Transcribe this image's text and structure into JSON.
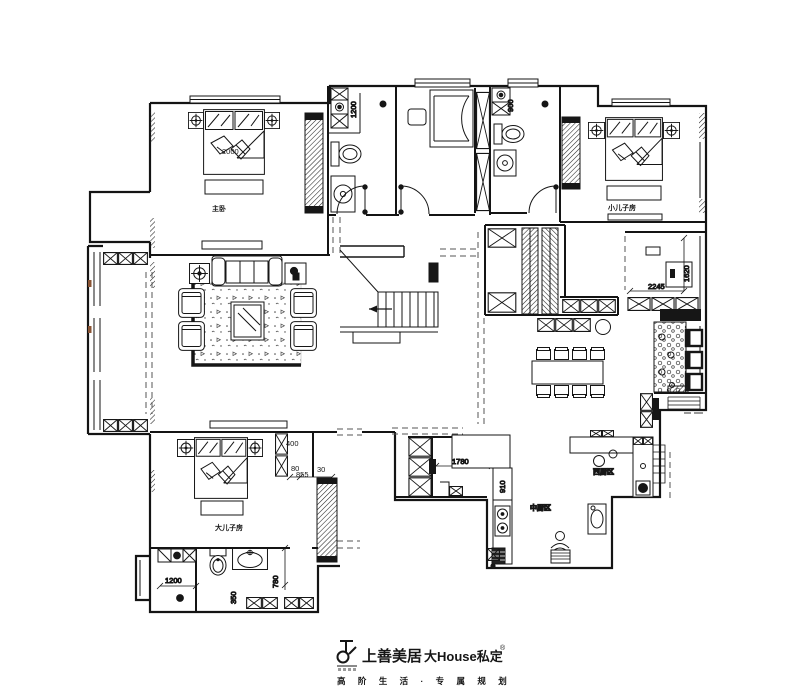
{
  "rooms": {
    "master": "主卧",
    "younger_son": "小儿子房",
    "elder_son": "大儿子房",
    "kitchen_cn": "中厨区",
    "kitchen_w": "西厨区"
  },
  "dims": {
    "d2000": "2000",
    "d1200_master": "1200",
    "d900": "900",
    "d2245": "2245",
    "d1620": "1620",
    "d400": "400",
    "d80": "80",
    "d855": "855",
    "d30": "30",
    "d1780": "1780",
    "d910": "910",
    "d1200_elder": "1200",
    "d780": "780",
    "d350": "350"
  },
  "footer": {
    "brand": "上善美居",
    "brand2": "大House私定",
    "reg": "®",
    "tagline": "高 阶 生 活 · 专 属 规 划"
  },
  "colors": {
    "line": "#1b1b1b",
    "accent": "#8a5434"
  }
}
